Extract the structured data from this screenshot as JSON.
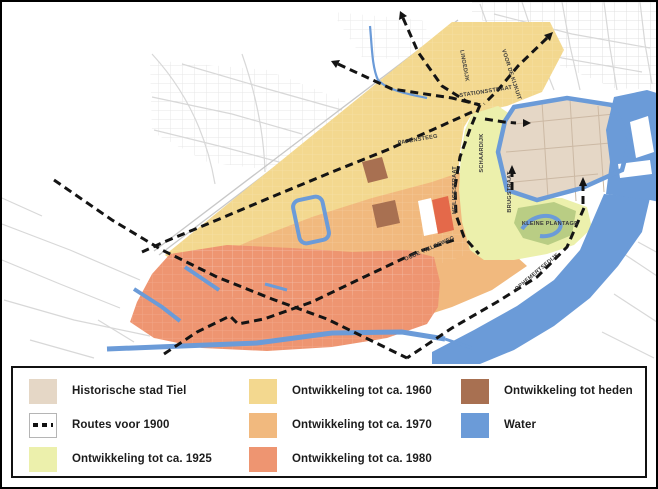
{
  "colors": {
    "historic": "#E5D7C6",
    "routes": "#141414",
    "y1925": "#ECF0AC",
    "y1960": "#F3D88F",
    "y1970": "#F1B97E",
    "y1980": "#EE9571",
    "heden": "#A87051",
    "water": "#6B9BD8",
    "background_streets": "#D8D8D8",
    "street_label_text": "#3A3A3A"
  },
  "legend": {
    "items": [
      {
        "id": "historic",
        "label": "Historische stad Tiel",
        "swatch": "fill",
        "color": "#E5D7C6"
      },
      {
        "id": "routes",
        "label": "Routes voor 1900",
        "swatch": "dash",
        "color": "#141414"
      },
      {
        "id": "y1925",
        "label": "Ontwikkeling tot ca. 1925",
        "swatch": "fill",
        "color": "#ECF0AC"
      },
      {
        "id": "y1960",
        "label": "Ontwikkeling tot ca. 1960",
        "swatch": "fill",
        "color": "#F3D88F"
      },
      {
        "id": "y1970",
        "label": "Ontwikkeling tot ca. 1970",
        "swatch": "fill",
        "color": "#F1B97E"
      },
      {
        "id": "y1980",
        "label": "Ontwikkeling tot ca. 1980",
        "swatch": "fill",
        "color": "#EE9571"
      },
      {
        "id": "heden",
        "label": "Ontwikkeling tot heden",
        "swatch": "fill",
        "color": "#A87051"
      },
      {
        "id": "water",
        "label": "Water",
        "swatch": "fill",
        "color": "#6B9BD8"
      }
    ]
  },
  "map": {
    "street_labels": [
      {
        "text": "LINGEDIJK",
        "x": 461,
        "y": 64,
        "rotate": 80
      },
      {
        "text": "STATIONSSTRAAT",
        "x": 484,
        "y": 91,
        "rotate": -9
      },
      {
        "text": "VOOR DE KIJKUIT",
        "x": 508,
        "y": 73,
        "rotate": 72
      },
      {
        "text": "SCHAARDIJK",
        "x": 481,
        "y": 151,
        "rotate": -90
      },
      {
        "text": "PAPENSTEEG",
        "x": 416,
        "y": 139,
        "rotate": -10
      },
      {
        "text": "HEILIGESTRAAT",
        "x": 454,
        "y": 188,
        "rotate": -90
      },
      {
        "text": "BRUGSTRAAT",
        "x": 509,
        "y": 190,
        "rotate": -90
      },
      {
        "text": "KLEINE PLANTAGE",
        "x": 548,
        "y": 223,
        "rotate": 0
      },
      {
        "text": "OUDE TIELSEWEG",
        "x": 428,
        "y": 248,
        "rotate": -24
      },
      {
        "text": "OPHEMERTSEDIJK",
        "x": 536,
        "y": 271,
        "rotate": -40
      }
    ]
  }
}
